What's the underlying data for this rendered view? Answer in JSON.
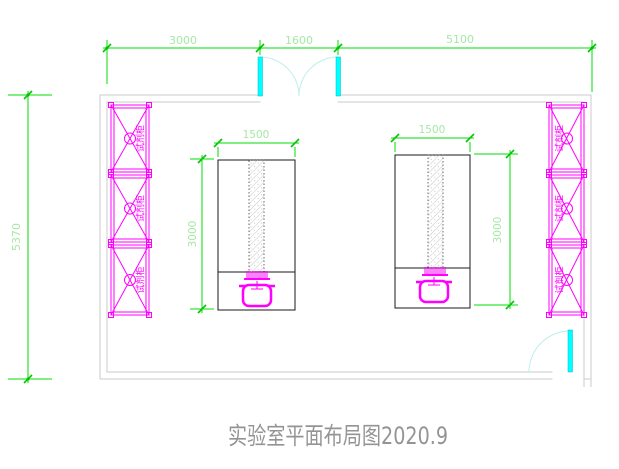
{
  "title": "实验室平面布局图2020.9",
  "dimensions": {
    "top_row": [
      "3000",
      "1600",
      "5100"
    ],
    "left_overall": "5370",
    "left_bench": {
      "width": "1500",
      "depth": "3000"
    },
    "right_bench": {
      "width": "1500",
      "depth": "3000"
    }
  },
  "cabinets": {
    "left": [
      {
        "label": "试剂柜"
      },
      {
        "label": "试剂柜"
      },
      {
        "label": "试剂柜"
      }
    ],
    "right": [
      {
        "label": "试剂柜"
      },
      {
        "label": "试剂柜"
      },
      {
        "label": "试剂柜"
      }
    ]
  },
  "colors": {
    "dimension_line": "#00dc00",
    "dimension_text": "#a5e8a5",
    "cabinet": "#ff00ff",
    "door_leaf": "#00ffff",
    "door_swing_arc": "#bdeeee",
    "wall": "#cbcbcb",
    "bench_outline": "#1a1a1a",
    "title_text": "#949494",
    "background": "#ffffff"
  }
}
